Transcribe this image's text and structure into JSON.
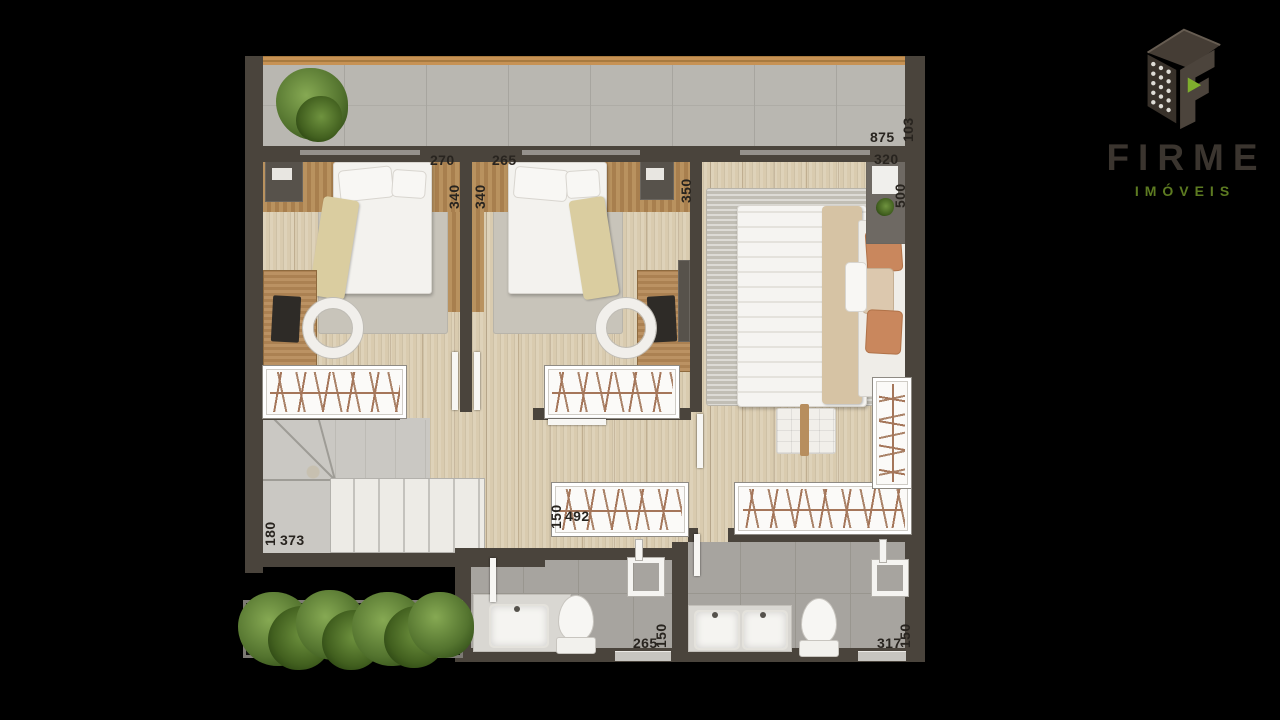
{
  "background": "#000000",
  "logo": {
    "brand": "FIRME",
    "tagline": "IMÓVEIS",
    "brand_color": "#3b352f",
    "tagline_color": "#5d7b21",
    "icon": "firme-building-f-icon",
    "icon_accent": "#7fae2d"
  },
  "floorplan": {
    "wall_color": "#4a443c",
    "wood_floor_color": "#d9cbaf",
    "balcony_floor_color": "#b9b7b1",
    "bathroom_floor_color": "#a7a49f",
    "dimensions": [
      {
        "v": "270",
        "axis": "horizontal"
      },
      {
        "v": "265",
        "axis": "horizontal"
      },
      {
        "v": "340",
        "axis": "vertical"
      },
      {
        "v": "340",
        "axis": "vertical"
      },
      {
        "v": "350",
        "axis": "vertical"
      },
      {
        "v": "320",
        "axis": "horizontal"
      },
      {
        "v": "500",
        "axis": "vertical"
      },
      {
        "v": "875",
        "axis": "horizontal"
      },
      {
        "v": "103",
        "axis": "vertical"
      },
      {
        "v": "180",
        "axis": "vertical"
      },
      {
        "v": "373",
        "axis": "horizontal"
      },
      {
        "v": "150",
        "axis": "vertical"
      },
      {
        "v": "492",
        "axis": "horizontal"
      },
      {
        "v": "265",
        "axis": "horizontal"
      },
      {
        "v": "150",
        "axis": "vertical"
      },
      {
        "v": "317",
        "axis": "horizontal"
      },
      {
        "v": "150",
        "axis": "vertical"
      }
    ]
  }
}
